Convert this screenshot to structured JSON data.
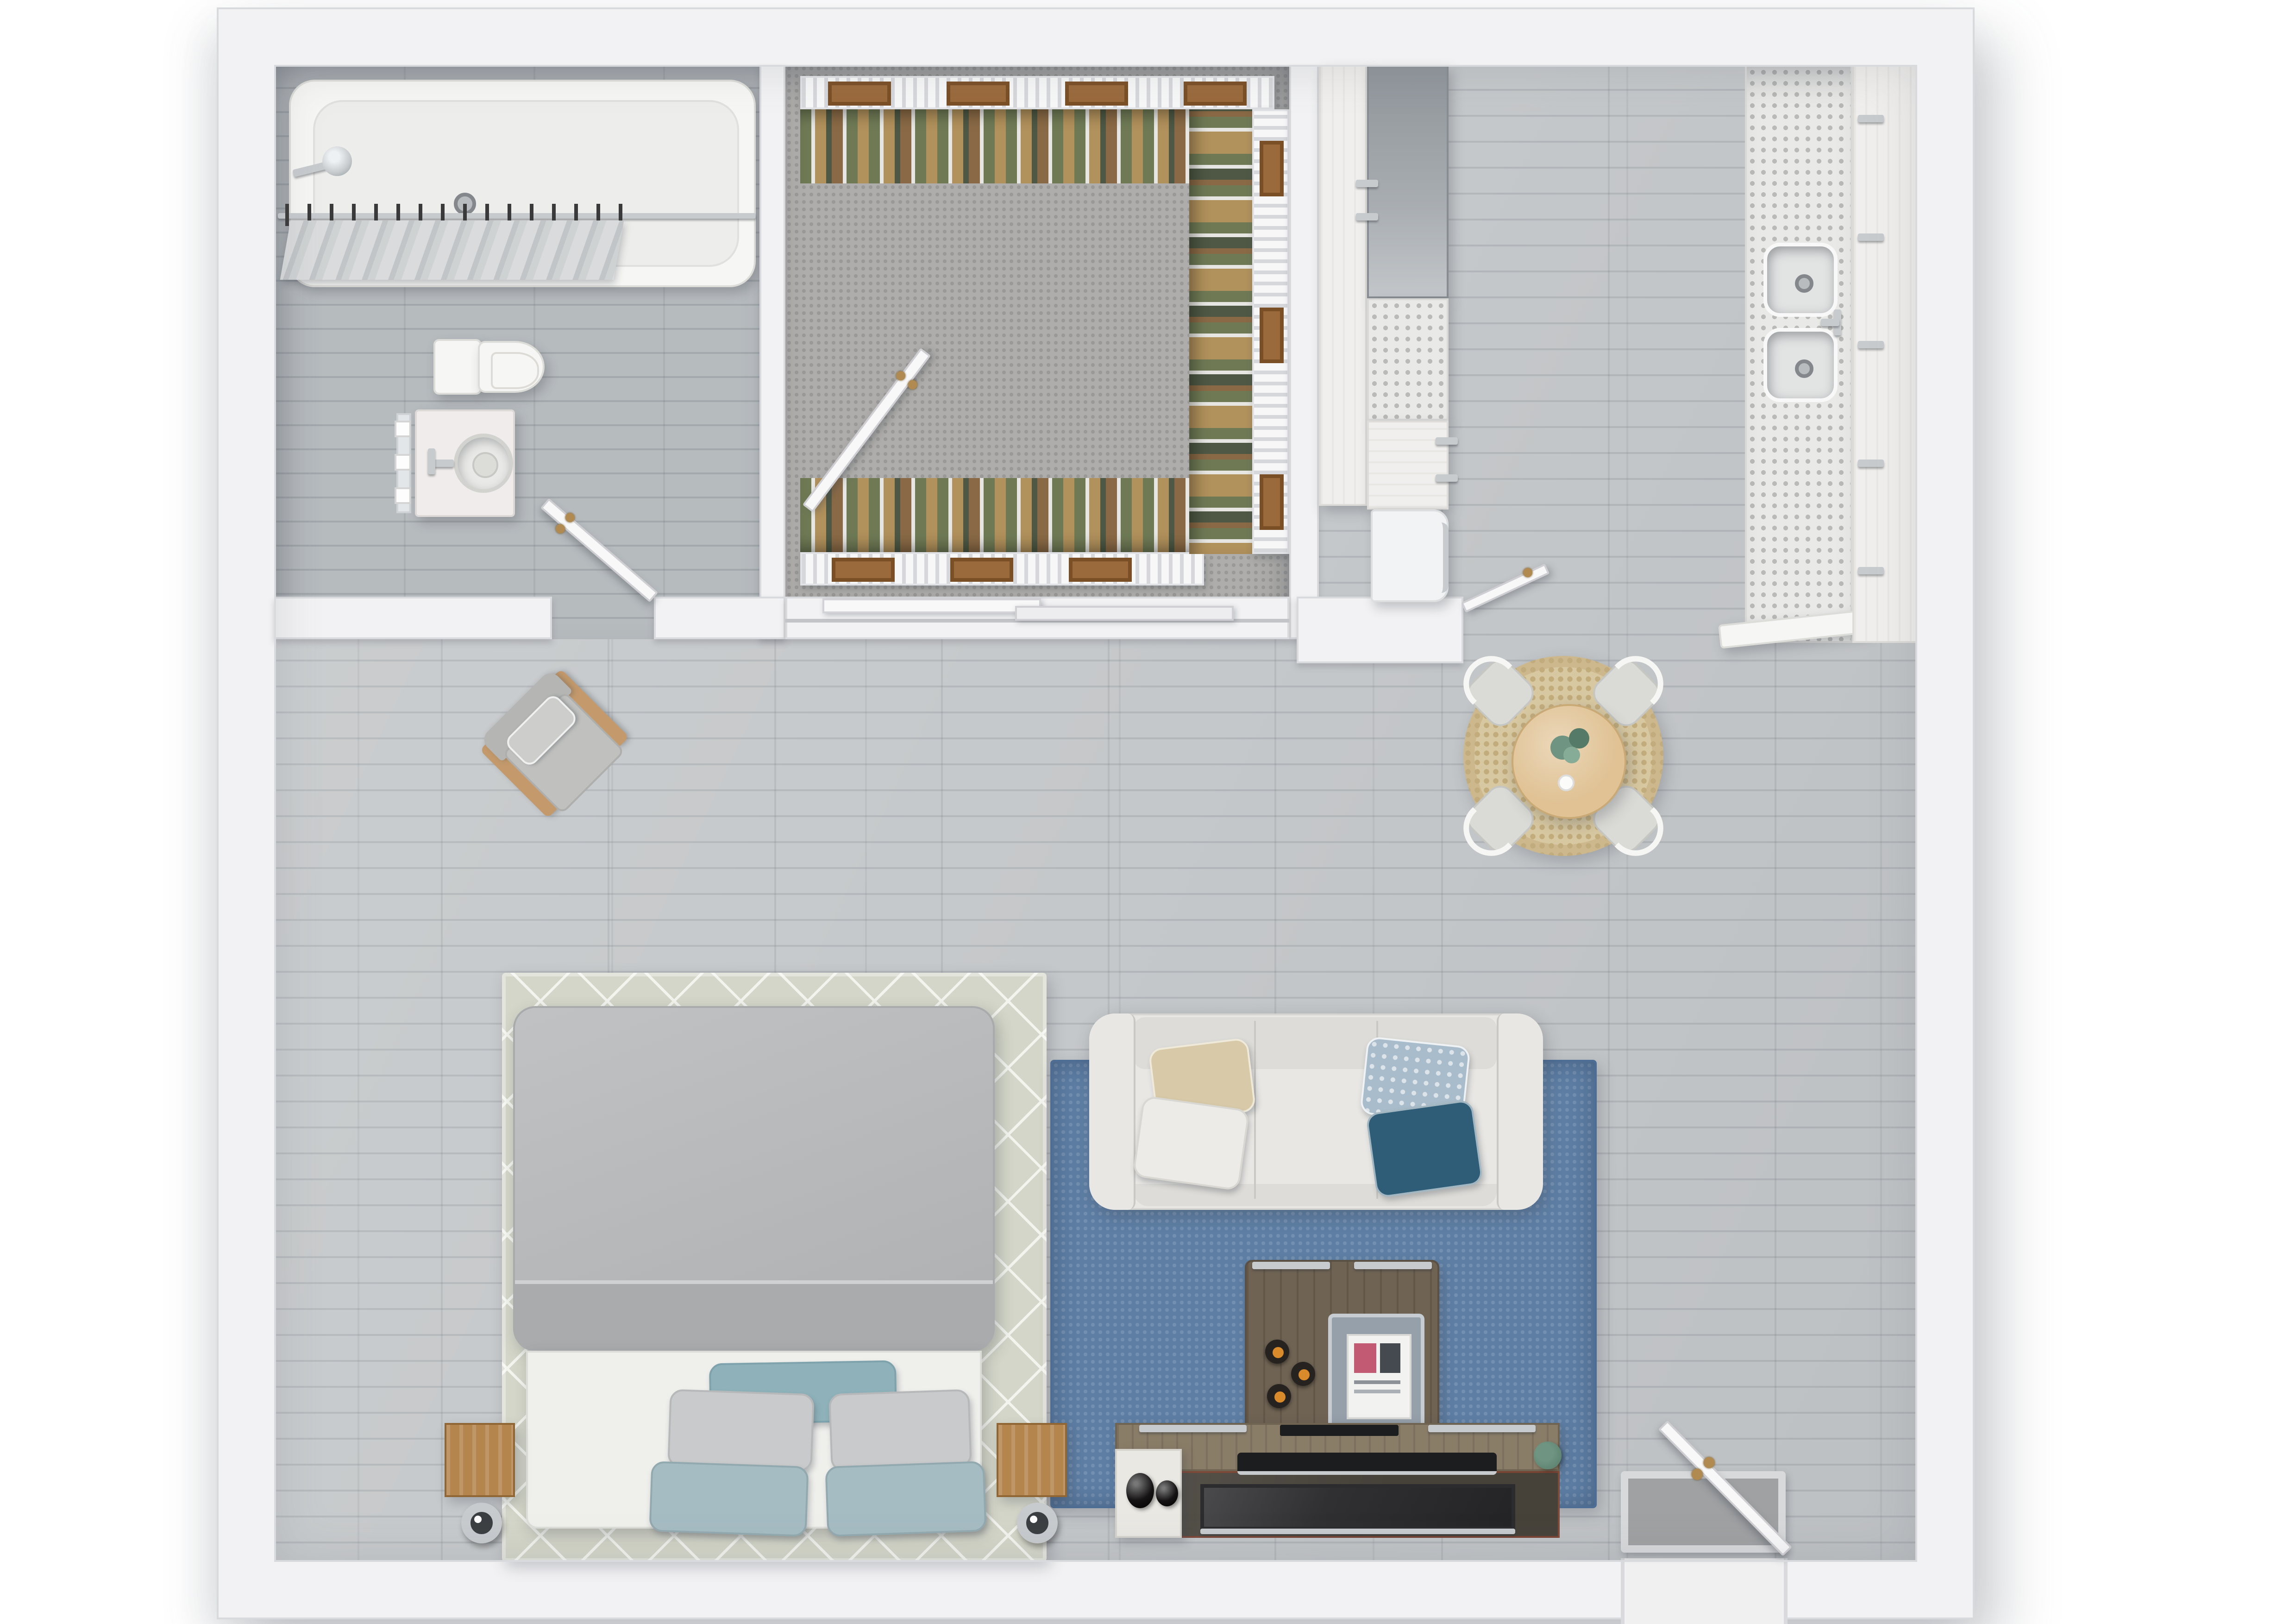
{
  "scene": {
    "title": "Studio apartment - top-down 3D floor plan",
    "view": "overhead render, no visible text labels"
  },
  "rooms": {
    "bathroom": {
      "name": "Bathroom",
      "items": [
        "bathtub",
        "shower curtain on rod",
        "wall shower fixture",
        "toilet",
        "vanity with round vessel sink",
        "swing door"
      ]
    },
    "closet": {
      "name": "Walk-in closet",
      "items": [
        "wire shelving on three sides",
        "hanging clothes",
        "wood storage boxes",
        "open swing door",
        "sliding bypass doors"
      ]
    },
    "kitchen": {
      "name": "Kitchen",
      "items": [
        "tall pantry cabinet",
        "range/appliance block",
        "terrazzo counter",
        "lower cabinets",
        "refrigerator",
        "counter run with double sink",
        "faucet",
        "cabinet run with handles"
      ]
    },
    "dining": {
      "name": "Dining area",
      "items": [
        "round jute rug",
        "round oak table",
        "plant centerpiece",
        "cup"
      ],
      "chair_count": 4
    },
    "living": {
      "name": "Living area",
      "items": [
        "three-seat sofa",
        "blue area rug",
        "coffee table with tray and magazine",
        "candles",
        "media console",
        "flat TV panel",
        "soundbar",
        "white media cabinet",
        "decorative vases",
        "small plant"
      ],
      "sofa_pillow_count": 4
    },
    "sleeping": {
      "name": "Sleeping area",
      "items": [
        "bed with grey duvet",
        "diamond-pattern area rug",
        "wood cube nightstands",
        "chrome drum lamps"
      ],
      "bed_pillow_count": 5,
      "nightstand_count": 2
    },
    "entry": {
      "name": "Entry",
      "items": [
        "entry door ajar",
        "framed door mat"
      ]
    },
    "reading": {
      "name": "Reading corner",
      "items": [
        "wood-frame armchair",
        "lumbar pillow"
      ]
    }
  },
  "palette": {
    "page_bg": "#ffffff",
    "wall": "#f2f2f4",
    "wall_edge": "#d9dadd",
    "floor_main": "#c6c9cb",
    "floor_main_dark": "#b4b8bb",
    "floor_bath": "#b6bbbe",
    "floor_bath_dark": "#a2a8ac",
    "carpet": "#aeadab",
    "carpet_dot": "#9a9997",
    "rug_blue": "#5e7ea4",
    "rug_blue_edge": "#4d6d94",
    "rug_bed": "#d4d6c9",
    "rug_bed_line": "#f3f4ee",
    "rug_jute": "#d8c8a1",
    "rug_jute_dot": "#c2ac7c",
    "sofa": "#e8e7e4",
    "sofa_line": "#c9c8c4",
    "sofa_front": "#dddcd8",
    "pillow_beige": "#d8caa8",
    "pillow_white": "#edebe7",
    "pillow_blue": "#a8bccb",
    "pillow_teal_dark": "#2f5d77",
    "duvet": "#b7b9bb",
    "duvet_fold": "#a9abad",
    "bed_base": "#efefec",
    "pillow_grey": "#c9cacb",
    "pillow_teal": "#8fb2ba",
    "pillow_teal_soft": "#a6bcc3",
    "wood_nightstand": "#b5854e",
    "wood_dining": "#e0c294",
    "wood_armchair": "#c49a6c",
    "wood_coffee": "#6f6353",
    "wood_console": "#8a7d68",
    "console_glass": "#46423a",
    "tray": "#96a0aa",
    "tv_black": "#2c2c2e",
    "soundbar_black": "#1c1d1f",
    "chrome": "#c7cbce",
    "brass": "#b08a50",
    "porcelain": "#f6f6f4",
    "tub_inner": "#ededeb",
    "cabinet_white": "#f0efed",
    "appliance_grey": "#9aa0a4",
    "terrazzo": "#e9e9e7",
    "terrazzo_dot": "#b9b9b7",
    "rack_white": "#f7f7f8",
    "rack_slat": "#d6d7da",
    "box_wood": "#9a6a3c",
    "box_wood_dark": "#7a4f26",
    "clothes_a": "#6f7a55",
    "clothes_b": "#b1915c",
    "clothes_c": "#e7e6e2",
    "clothes_d": "#4e5844",
    "clothes_e": "#8a6a46",
    "plant_green": "#6f9582",
    "plant_green_dark": "#557a68",
    "mat_grey": "#9fa1a3",
    "mat_border": "#d8d9db",
    "door_white": "#f8f8f9"
  }
}
